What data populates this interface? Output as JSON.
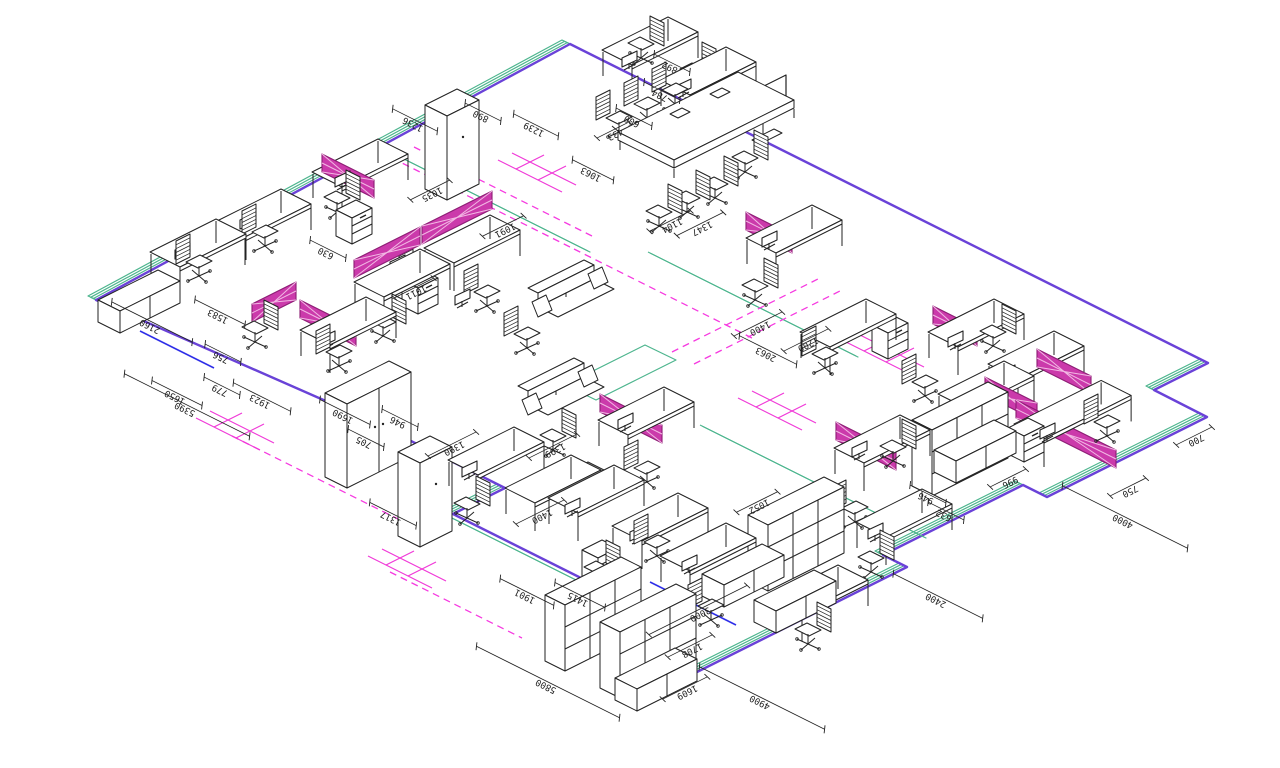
{
  "drawing": {
    "kind": "isometric office furniture floor plan",
    "background": "#ffffff"
  },
  "colors": {
    "line": "#222222",
    "floor_green": "#4db58e",
    "floor_purple": "#6a42d8",
    "accent_blue": "#2f2fe8",
    "aisle_magenta": "#f63ae0",
    "grid_magenta": "#f03ad8",
    "screen_fill": "#cb3aab",
    "screen_edge": "#8c1d74",
    "screen_lattice": "#f2b9e4"
  },
  "dimension_labels": [
    {
      "t": "2160",
      "x": 152,
      "y": 322,
      "a": "u",
      "l": 90
    },
    {
      "t": "1650",
      "x": 177,
      "y": 393,
      "a": "u",
      "l": 56
    },
    {
      "t": "5390",
      "x": 187,
      "y": 405,
      "a": "u",
      "l": 140
    },
    {
      "t": "779",
      "x": 222,
      "y": 386,
      "a": "u",
      "l": 40
    },
    {
      "t": "1923",
      "x": 262,
      "y": 397,
      "a": "u",
      "l": 64
    },
    {
      "t": "1583",
      "x": 220,
      "y": 312,
      "a": "u",
      "l": 56
    },
    {
      "t": "756",
      "x": 223,
      "y": 353,
      "a": "u",
      "l": 40
    },
    {
      "t": "630",
      "x": 328,
      "y": 249,
      "a": "u",
      "l": 40
    },
    {
      "t": "1011",
      "x": 414,
      "y": 288,
      "a": "v",
      "l": 44
    },
    {
      "t": "1091",
      "x": 503,
      "y": 226,
      "a": "v",
      "l": 46
    },
    {
      "t": "1035",
      "x": 430,
      "y": 190,
      "a": "v",
      "l": 44
    },
    {
      "t": "1236",
      "x": 415,
      "y": 120,
      "a": "u",
      "l": 50
    },
    {
      "t": "890",
      "x": 483,
      "y": 112,
      "a": "u",
      "l": 40
    },
    {
      "t": "1239",
      "x": 536,
      "y": 125,
      "a": "u",
      "l": 50
    },
    {
      "t": "600",
      "x": 634,
      "y": 117,
      "a": "u",
      "l": 40
    },
    {
      "t": "433",
      "x": 613,
      "y": 130,
      "a": "v",
      "l": 36
    },
    {
      "t": "1063",
      "x": 593,
      "y": 170,
      "a": "u",
      "l": 46
    },
    {
      "t": "892",
      "x": 672,
      "y": 63,
      "a": "u",
      "l": 40
    },
    {
      "t": "784",
      "x": 662,
      "y": 91,
      "a": "u",
      "l": 40
    },
    {
      "t": "1104",
      "x": 670,
      "y": 221,
      "a": "v",
      "l": 46
    },
    {
      "t": "1347",
      "x": 700,
      "y": 224,
      "a": "v",
      "l": 52
    },
    {
      "t": "1400",
      "x": 758,
      "y": 324,
      "a": "v",
      "l": 54
    },
    {
      "t": "1200",
      "x": 806,
      "y": 340,
      "a": "v",
      "l": 50
    },
    {
      "t": "2063",
      "x": 768,
      "y": 350,
      "a": "u",
      "l": 64
    },
    {
      "t": "1399",
      "x": 553,
      "y": 446,
      "a": "v",
      "l": 54
    },
    {
      "t": "1390",
      "x": 452,
      "y": 444,
      "a": "v",
      "l": 54
    },
    {
      "t": "1690",
      "x": 345,
      "y": 412,
      "a": "u",
      "l": 56
    },
    {
      "t": "705",
      "x": 366,
      "y": 438,
      "a": "u",
      "l": 40
    },
    {
      "t": "946",
      "x": 400,
      "y": 418,
      "a": "u",
      "l": 40
    },
    {
      "t": "1317",
      "x": 393,
      "y": 514,
      "a": "u",
      "l": 52
    },
    {
      "t": "1400",
      "x": 540,
      "y": 512,
      "a": "v",
      "l": 54
    },
    {
      "t": "1901",
      "x": 527,
      "y": 592,
      "a": "u",
      "l": 60
    },
    {
      "t": "1415",
      "x": 580,
      "y": 595,
      "a": "u",
      "l": 56
    },
    {
      "t": "5800",
      "x": 548,
      "y": 682,
      "a": "u",
      "l": 160
    },
    {
      "t": "3000",
      "x": 698,
      "y": 610,
      "a": "v",
      "l": 110
    },
    {
      "t": "1708",
      "x": 690,
      "y": 646,
      "a": "v",
      "l": 50
    },
    {
      "t": "1609",
      "x": 685,
      "y": 688,
      "a": "v",
      "l": 50
    },
    {
      "t": "4900",
      "x": 762,
      "y": 698,
      "a": "u",
      "l": 140
    },
    {
      "t": "2400",
      "x": 938,
      "y": 596,
      "a": "u",
      "l": 100
    },
    {
      "t": "4000",
      "x": 1125,
      "y": 517,
      "a": "u",
      "l": 140
    },
    {
      "t": "750",
      "x": 1128,
      "y": 487,
      "a": "v",
      "l": 40
    },
    {
      "t": "700",
      "x": 1194,
      "y": 436,
      "a": "v",
      "l": 40
    },
    {
      "t": "1052",
      "x": 757,
      "y": 502,
      "a": "v",
      "l": 46
    },
    {
      "t": "946",
      "x": 928,
      "y": 494,
      "a": "u",
      "l": 40
    },
    {
      "t": "632",
      "x": 946,
      "y": 511,
      "a": "u",
      "l": 40
    },
    {
      "t": "996",
      "x": 1008,
      "y": 478,
      "a": "v",
      "l": 40
    }
  ],
  "furniture": {
    "desks": [
      [
        150,
        252
      ],
      [
        215,
        222
      ],
      [
        312,
        172
      ],
      [
        354,
        282
      ],
      [
        424,
        248
      ],
      [
        300,
        330
      ],
      [
        598,
        420
      ],
      [
        834,
        448
      ],
      [
        746,
        238
      ],
      [
        800,
        332
      ],
      [
        928,
        332
      ],
      [
        988,
        364
      ],
      [
        938,
        394
      ],
      [
        602,
        50
      ],
      [
        660,
        80
      ],
      [
        548,
        498
      ],
      [
        612,
        526
      ],
      [
        448,
        460
      ],
      [
        505,
        488
      ],
      [
        856,
        522
      ],
      [
        660,
        556
      ],
      [
        772,
        598
      ]
    ],
    "desks_wide": [
      [
        1014,
        424
      ]
    ],
    "chairs": [
      [
        192,
        262,
        0
      ],
      [
        258,
        232,
        0
      ],
      [
        344,
        198,
        1
      ],
      [
        415,
        262,
        0
      ],
      [
        480,
        292,
        0
      ],
      [
        332,
        352,
        0
      ],
      [
        262,
        328,
        1
      ],
      [
        390,
        322,
        1
      ],
      [
        648,
        44,
        1
      ],
      [
        700,
        70,
        1
      ],
      [
        612,
        118,
        0
      ],
      [
        640,
        104,
        0
      ],
      [
        668,
        90,
        0
      ],
      [
        666,
        212,
        1
      ],
      [
        694,
        198,
        1
      ],
      [
        722,
        184,
        1
      ],
      [
        752,
        158,
        1
      ],
      [
        640,
        468,
        0
      ],
      [
        560,
        436,
        1
      ],
      [
        848,
        508,
        0
      ],
      [
        762,
        286,
        1
      ],
      [
        818,
        354,
        0
      ],
      [
        918,
        382,
        0
      ],
      [
        1000,
        332,
        1
      ],
      [
        900,
        447,
        1
      ],
      [
        1100,
        422,
        0
      ],
      [
        878,
        558,
        1
      ],
      [
        650,
        542,
        0
      ],
      [
        604,
        568,
        1
      ],
      [
        704,
        606,
        0
      ],
      [
        474,
        504,
        1
      ],
      [
        520,
        334,
        0
      ],
      [
        815,
        630,
        1
      ]
    ],
    "privacy_screens": [
      [
        322,
        172,
        52,
        "u"
      ],
      [
        354,
        278,
        66,
        "v"
      ],
      [
        422,
        244,
        70,
        "v"
      ],
      [
        300,
        318,
        56,
        "u"
      ],
      [
        252,
        322,
        44,
        "v"
      ],
      [
        600,
        412,
        62,
        "u"
      ],
      [
        836,
        440,
        60,
        "u"
      ],
      [
        746,
        230,
        46,
        "u"
      ],
      [
        933,
        324,
        44,
        "u"
      ],
      [
        1037,
        367,
        54,
        "u"
      ],
      [
        985,
        395,
        52,
        "u"
      ],
      [
        1016,
        418,
        100,
        "u"
      ]
    ],
    "wardrobes_double": [
      [
        325,
        393
      ]
    ],
    "wardrobes_single": [
      [
        398,
        452
      ],
      [
        425,
        105
      ]
    ],
    "bookcases": [
      [
        545,
        595
      ],
      [
        600,
        622
      ],
      [
        748,
        515
      ],
      [
        912,
        420
      ]
    ],
    "low_cabinets": [
      [
        98,
        300
      ],
      [
        615,
        678
      ],
      [
        702,
        574
      ],
      [
        754,
        600
      ],
      [
        934,
        450
      ]
    ],
    "pedestals": [
      [
        336,
        210
      ],
      [
        402,
        280
      ],
      [
        568,
        472
      ],
      [
        872,
        325
      ],
      [
        1008,
        428
      ],
      [
        582,
        550
      ]
    ],
    "sofas": [
      [
        528,
        288
      ],
      [
        518,
        386
      ]
    ],
    "monitors": [
      [
        175,
        250
      ],
      [
        240,
        220
      ],
      [
        335,
        178
      ],
      [
        390,
        262
      ],
      [
        455,
        296
      ],
      [
        320,
        338
      ],
      [
        618,
        420
      ],
      [
        852,
        448
      ],
      [
        762,
        238
      ],
      [
        948,
        338
      ],
      [
        1000,
        372
      ],
      [
        1040,
        430
      ],
      [
        622,
        58
      ],
      [
        676,
        86
      ],
      [
        565,
        505
      ],
      [
        630,
        532
      ],
      [
        462,
        468
      ],
      [
        868,
        530
      ],
      [
        682,
        562
      ]
    ],
    "meeting_table": [
      [
        618,
        132
      ]
    ],
    "tv_panel": [
      [
        740,
        98
      ]
    ]
  },
  "floor_markings": {
    "aisle_dashed": [
      [
        392,
        158,
        574,
        249
      ],
      [
        414,
        147,
        596,
        238
      ],
      [
        574,
        249,
        754,
        339
      ],
      [
        672,
        352,
        818,
        279
      ],
      [
        694,
        364,
        840,
        291
      ],
      [
        232,
        436,
        420,
        530
      ],
      [
        390,
        572,
        522,
        638
      ]
    ],
    "grid_marks": [
      [
        196,
        418
      ],
      [
        368,
        556
      ],
      [
        498,
        160
      ],
      [
        738,
        398
      ],
      [
        846,
        342
      ]
    ],
    "blue_segments": [
      [
        140,
        331,
        214,
        368
      ],
      [
        650,
        582,
        736,
        625
      ]
    ],
    "interior_lines": [
      [
        390,
        152,
        588,
        251
      ],
      [
        648,
        252,
        856,
        356
      ],
      [
        448,
        516,
        688,
        636
      ],
      [
        700,
        425,
        924,
        537
      ]
    ],
    "platform": [
      [
        565,
        385
      ],
      [
        645,
        345
      ],
      [
        676,
        360
      ],
      [
        596,
        400
      ]
    ]
  }
}
